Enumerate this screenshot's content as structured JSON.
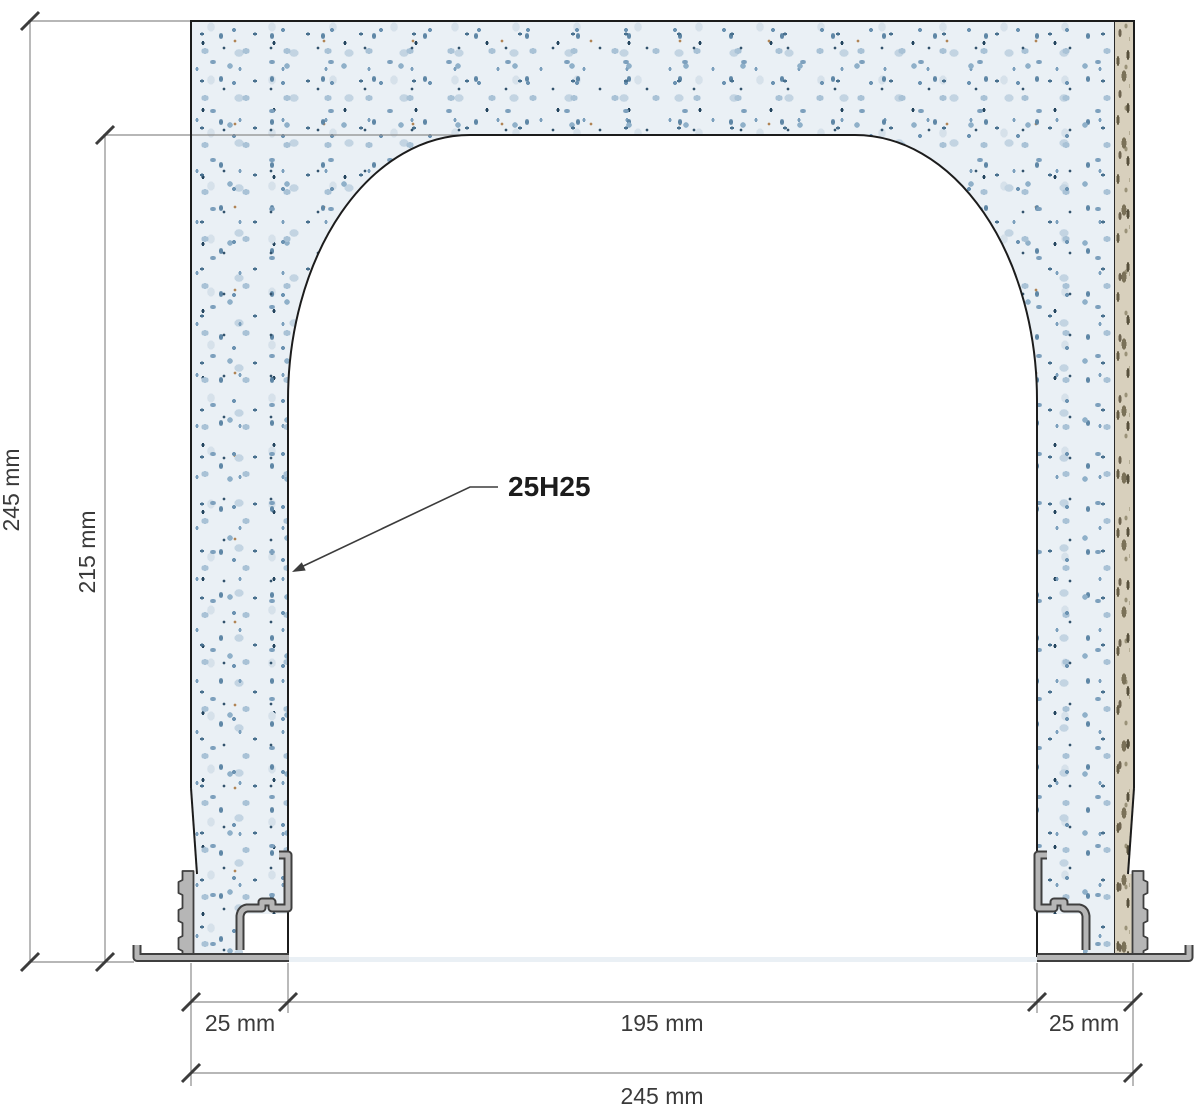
{
  "drawing": {
    "part_label": "25H25",
    "dimensions": {
      "total_height": "245 mm",
      "opening_height": "215 mm",
      "left_jamb_width": "25 mm",
      "opening_width": "195 mm",
      "right_jamb_width": "25 mm",
      "total_width": "245 mm"
    },
    "colors": {
      "body_speckle_base": "#eaf0f5",
      "speckle_accent": "#5f87a6",
      "liner_strip_base": "#d8d0bd",
      "metal_profile_fill": "#b6b6b6",
      "metal_profile_outline": "#3f3f3f",
      "body_outline": "#1c1c1c",
      "dimension_line": "#8c8c8c",
      "tick_mark": "#3c3c3c",
      "label_text": "#3a3a3a"
    }
  }
}
